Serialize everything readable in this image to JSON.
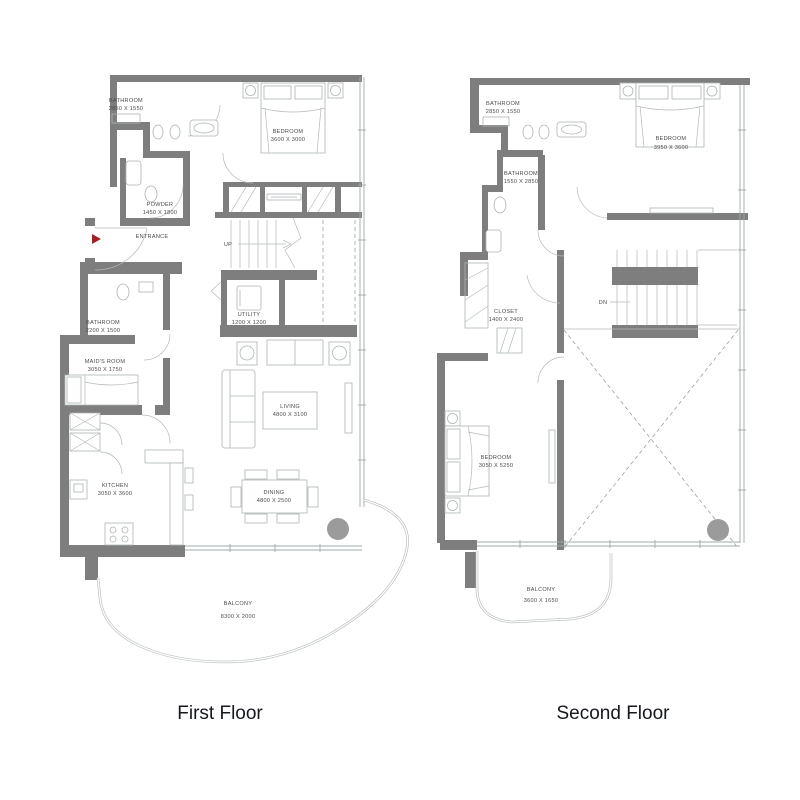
{
  "colors": {
    "wall": "#7e7e7e",
    "furniture_line": "#aeb4b4",
    "entrance_arrow": "#a32125",
    "column": "#9b9b9b",
    "label_text": "#4c4c4c",
    "title_text": "#15181d",
    "background": "#ffffff"
  },
  "floors": {
    "first": {
      "title": "First Floor",
      "rooms": {
        "bathroom_top": {
          "name": "BATHROOM",
          "dims": "2850 X 1550"
        },
        "bedroom": {
          "name": "BEDROOM",
          "dims": "3600 X 3000"
        },
        "powder": {
          "name": "POWDER",
          "dims": "1450 X 1800"
        },
        "entrance": {
          "name": "ENTRANCE"
        },
        "stairs": {
          "name": "UP"
        },
        "utility": {
          "name": "UTILITY",
          "dims": "1200 X 1200"
        },
        "bathroom_mid": {
          "name": "BATHROOM",
          "dims": "2200 X 1500"
        },
        "maids_room": {
          "name": "MAID'S ROOM",
          "dims": "3050 X 1750"
        },
        "living": {
          "name": "LIVING",
          "dims": "4800 X 3100"
        },
        "kitchen": {
          "name": "KITCHEN",
          "dims": "3050 X 3600"
        },
        "dining": {
          "name": "DINING",
          "dims": "4800 X 2500"
        },
        "balcony": {
          "name": "BALCONY",
          "dims": "8300 X 2000"
        }
      }
    },
    "second": {
      "title": "Second Floor",
      "rooms": {
        "bathroom_top": {
          "name": "BATHROOM",
          "dims": "2850 X 1550"
        },
        "bedroom_top": {
          "name": "BEDROOM",
          "dims": "3950 X 3600"
        },
        "bathroom_mid": {
          "name": "BATHROOM",
          "dims": "1550 X 2850"
        },
        "closet": {
          "name": "CLOSET",
          "dims": "1400 X 2400"
        },
        "stairs": {
          "name": "DN"
        },
        "bedroom_bottom": {
          "name": "BEDROOM",
          "dims": "3050 X 5250"
        },
        "balcony": {
          "name": "BALCONY",
          "dims": "3600 X 1650"
        }
      }
    }
  }
}
